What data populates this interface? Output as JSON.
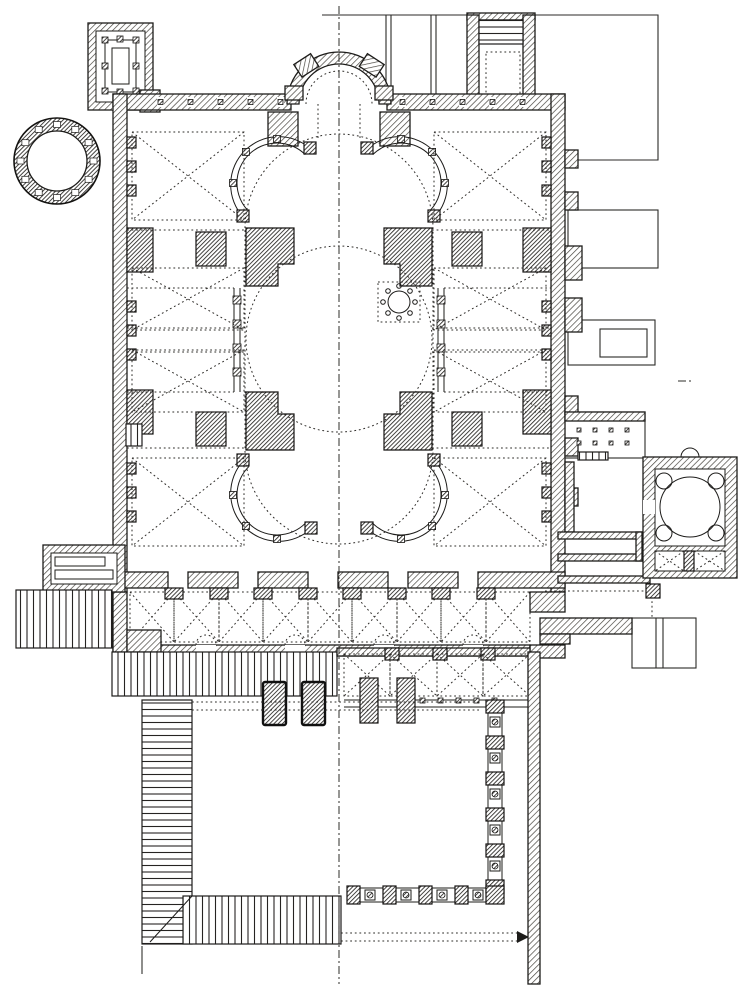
{
  "figure": {
    "type": "architectural-floor-plan",
    "style": "engraved black-ink line drawing on white paper, hatched masonry walls, dotted vault and dome projection lines",
    "colors": {
      "paper": "#ffffff",
      "ink": "#1d1c1a",
      "wall_hatch": "#4a4741",
      "pier_hatch": "#24221f"
    },
    "elements": [
      "apse",
      "central-dome-outline",
      "nave-oval-outline",
      "omphalion-marble-panel",
      "corner-exedrae-colonnades",
      "main-dome-piers",
      "side-aisle-vault-bays",
      "nave-colonnades",
      "narthex-bays",
      "exonarthex-bays",
      "entrance-steps-bands",
      "atrium-courtyard",
      "atrium-colonnade-piers",
      "rotunda-annex",
      "rectangular-annex-with-columns",
      "domed-baptistery-annex",
      "ramp-block",
      "outlined-adjacent-buildings",
      "axis-centerline"
    ]
  }
}
